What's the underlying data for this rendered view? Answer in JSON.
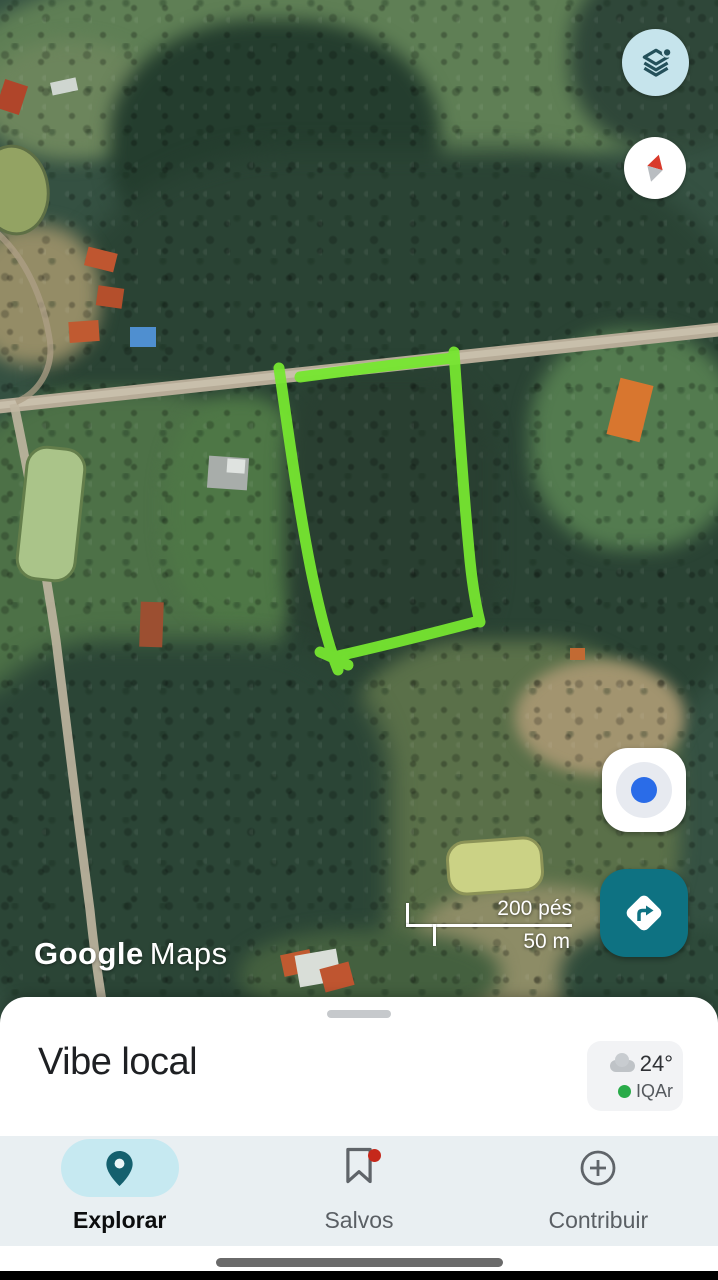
{
  "app_title": "Google Maps",
  "map": {
    "watermark_google": "Google",
    "watermark_maps": "Maps",
    "scale": {
      "imperial_label": "200 pés",
      "metric_label": "50 m"
    },
    "controls": {
      "layers": "layers",
      "compass": "compass",
      "my_location": "my-location",
      "directions": "directions"
    },
    "annotation": {
      "shape": "hand-drawn land parcel outline",
      "color": "#76e630"
    }
  },
  "sheet": {
    "title": "Vibe local",
    "weather": {
      "temperature": "24°",
      "air_quality_label": "IQAr"
    }
  },
  "nav": {
    "items": [
      {
        "label": "Explorar",
        "active": true
      },
      {
        "label": "Salvos",
        "badge": true
      },
      {
        "label": "Contribuir",
        "badge": false
      }
    ]
  },
  "colors": {
    "accent_teal": "#0e7282",
    "layers_button_bg": "#c6e4ec",
    "active_pill": "#c6e9f1",
    "polygon_green": "#76e630",
    "location_dot_blue": "#2a6ce8",
    "badge_red": "#c5281b",
    "air_quality_green": "#29ab49",
    "nav_bg": "#e9eff2"
  }
}
